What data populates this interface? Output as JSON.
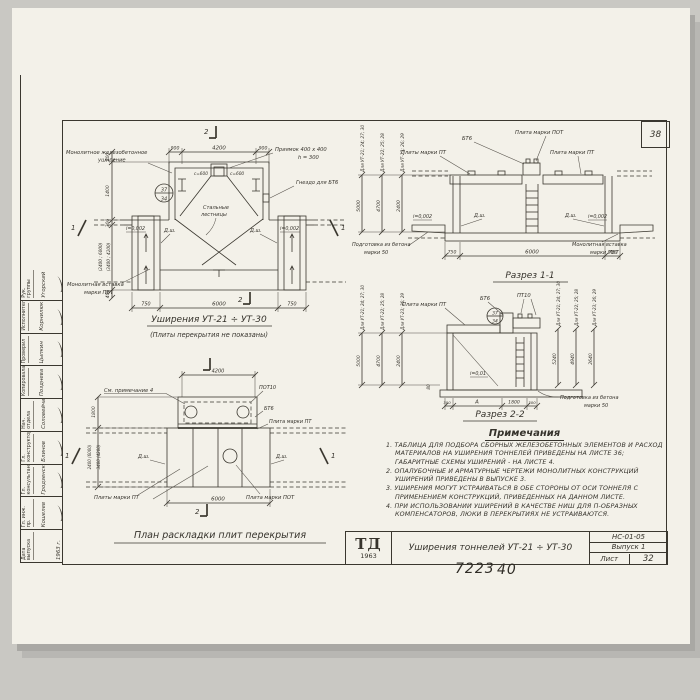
{
  "colors": {
    "paper": "#f3f1e9",
    "ink": "#3a372f"
  },
  "page": {
    "corner_number": "38",
    "hand_left": "7223",
    "hand_right": "40"
  },
  "stamp": {
    "rows": [
      {
        "role": "Рук. группы",
        "name": "Угорский"
      },
      {
        "role": "Исполнитель",
        "name": "Корнилюк"
      },
      {
        "role": "Проверил",
        "name": "Цыпкин"
      },
      {
        "role": "Копировала",
        "name": "Позднева"
      },
      {
        "role": "Нач. отдела",
        "name": "Соловейчик"
      },
      {
        "role": "Гл. конструктор",
        "name": "Блинов"
      },
      {
        "role": "Гл. консультант",
        "name": "Гродзенский"
      },
      {
        "role": "Гл. инж. пр.",
        "name": "Кошелев"
      },
      {
        "role": "Дата выпуска",
        "name": "1963 г."
      }
    ]
  },
  "view_a": {
    "title": "Уширения УТ-21 ÷ УТ-30",
    "subtitle": "(Плиты перекрытия не показаны)",
    "label_widening_1": "Монолитное железобетонное",
    "label_widening_2": "уширение",
    "label_pit_1": "Приямок 400 x 400",
    "label_pit_2": "h = 300",
    "label_socket": "Гнездо для БТ6",
    "label_steel_1": "Стальные",
    "label_steel_2": "лестницы",
    "label_insert_1": "Монолитная вставка",
    "label_insert_2": "марки ПВТ",
    "pit_mark_left": "с=600",
    "pit_mark_right": "с=600",
    "joint": "Д.ш.",
    "slope": "i=0,002",
    "node_mark_top": "37",
    "node_mark_bottom": "34",
    "dim_top_1": "900",
    "dim_top_2": "4200",
    "dim_top_3": "900",
    "dim_bottom_1": "750",
    "dim_bottom_2": "6000",
    "dim_bottom_3": "750",
    "dim_left_1": "200",
    "dim_left_2": "1400",
    "dim_left_3": "300",
    "dim_left_4": "(2400 ; 6000)",
    "dim_left_5": "(3400 ; 4200)",
    "dim_left_6": "400",
    "marker_section": "2",
    "marker_side": "1"
  },
  "section_1": {
    "title": "Разрез 1-1",
    "label_pt_plates": "Плиты марки ПТ",
    "label_bt6": "БТ6",
    "label_pot": "Плита марки ПОТ",
    "label_pt": "Плита марки ПТ",
    "label_prep_1": "Подготовка из бетона",
    "label_prep_2": "марки 50",
    "label_insert_1": "Монолитная вставка",
    "label_insert_2": "марки МВТ",
    "joint": "Д.ш.",
    "slope": "i=0,002",
    "dim_bottom_1": "750",
    "dim_bottom_2": "6000",
    "dim_bottom_3": "750",
    "groups": [
      {
        "label": "Для УТ-21; 24; 27; 30",
        "dim": "5000"
      },
      {
        "label": "Для УТ-22; 25; 28",
        "dim": "4700"
      },
      {
        "label": "Для УТ-23; 26; 29",
        "dim": "2400"
      }
    ]
  },
  "section_2": {
    "title": "Разрез 2-2",
    "label_pt": "Плита марки ПТ",
    "label_bt6": "БТ6",
    "label_pt10": "ПТ10",
    "slope": "i=0,01",
    "label_prep_1": "Подготовка из бетона",
    "label_prep_2": "марки 50",
    "node_mark_top": "37",
    "node_mark_bottom": "34",
    "dim_bottom_1": "300",
    "dim_bottom_2": "А",
    "dim_bottom_3": "1800",
    "dim_bottom_4": "300",
    "dim_left_small": "80",
    "groups_left": [
      {
        "label": "Для УТ-21; 24; 27; 30",
        "dim": "5000"
      },
      {
        "label": "Для УТ-22; 25; 28",
        "dim": "4700"
      },
      {
        "label": "Для УТ-23; 26; 29",
        "dim": "2400"
      }
    ],
    "groups_right": [
      {
        "label": "Для УТ-21; 24; 27; 30",
        "dim": "5240"
      },
      {
        "label": "Для УТ-22; 25; 28",
        "dim": "4940"
      },
      {
        "label": "Для УТ-23; 26; 29",
        "dim": "2640"
      }
    ]
  },
  "plan": {
    "title": "План раскладки плит перекрытия",
    "label_note": "См. примечание 4",
    "label_pot10": "ПОТ10",
    "label_bt6": "БТ6",
    "label_pt": "Плита марки ПТ",
    "joint": "Д.ш.",
    "label_pts": "Плиты марки ПТ",
    "label_pot": "Плита марки ПОТ",
    "dim_top": "4200",
    "dim_bottom": "6000",
    "dim_left_1": "1800",
    "dim_left_2": "2400 (6000)",
    "dim_left_3": "3400 (4200)",
    "marker_section": "2",
    "marker_side": "1"
  },
  "notes": {
    "title": "Примечания",
    "items": [
      "1. Таблица для подбора сборных железобетонных элементов и расход материалов на уширения тоннелей приведены на листе 36; габаритные схемы уширений - на листе 4.",
      "2. Опалубочные и арматурные чертежи монолитных конструкций уширений приведены в выпуске 3.",
      "3. Уширения могут устраиваться в обе стороны от оси тоннеля с применением конструкций, приведенных на данном листе.",
      "4. При использовании уширений в качестве ниш для П-образных компенсаторов, люки в перекрытиях не устраиваются."
    ]
  },
  "title_block": {
    "logo": "ТД",
    "logo_year": "1963",
    "title": "Уширения тоннелей УТ-21 ÷ УТ-30",
    "code": "НС-01-05",
    "issue": "Выпуск 1",
    "sheet_label": "Лист",
    "sheet_number": "32"
  }
}
